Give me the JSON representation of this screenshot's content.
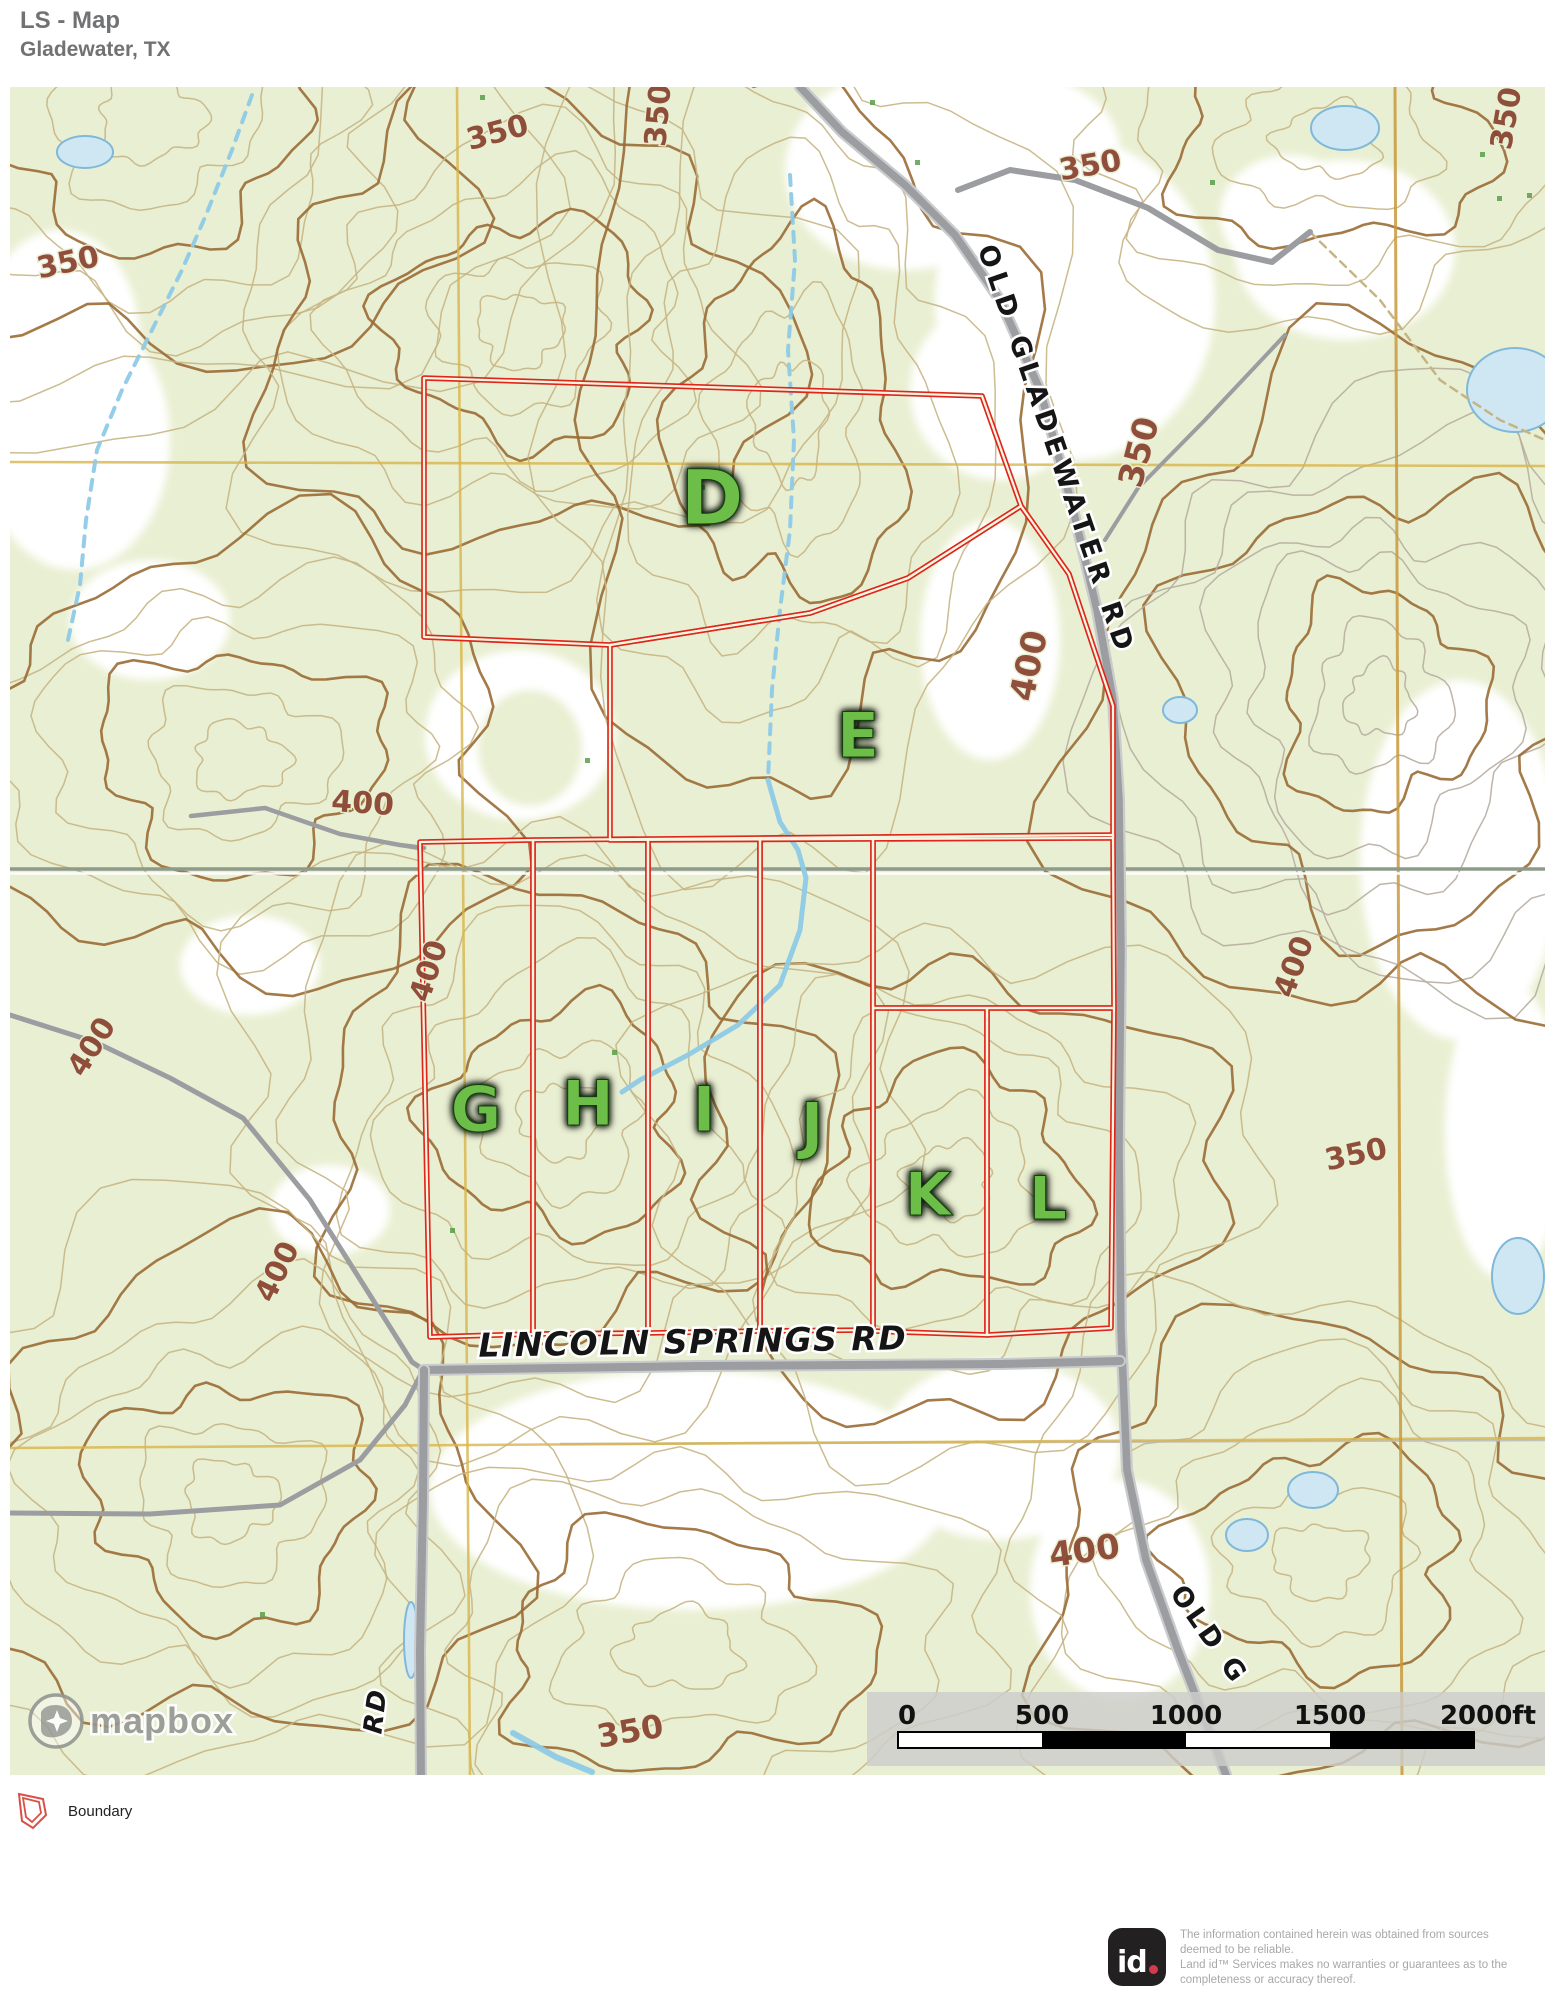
{
  "header": {
    "title": "LS - Map",
    "subtitle": "Gladewater, TX"
  },
  "legend": {
    "boundary_label": "Boundary"
  },
  "attribution": {
    "mapbox_label": "mapbox"
  },
  "footer": {
    "disclaimer": "The information contained herein was obtained from sources\ndeemed to be reliable.\nLand id™ Services makes no warranties or guarantees as to the\ncompleteness or accuracy thereof."
  },
  "colors": {
    "map_bg": "#e9efd2",
    "white_patch": "#ffffff",
    "contour": "#c6b584",
    "contour_gray": "#b7ada0",
    "contour_index": "#9a6b35",
    "contour_label": "#8b4632",
    "water_fill": "#cfe7f3",
    "water_stroke": "#7fb8d9",
    "stream": "#8ecae6",
    "road_core": "#9b9da0",
    "road_casing": "#c9cbcd",
    "grid_yellow": "#d9b54a",
    "grid_orange": "#c99a3e",
    "section_line": "#8e9b8a",
    "parcel_red": "#e0251b",
    "parcel_inner": "#f3f6e0",
    "letter_green": "#6cbe4a",
    "letter_glow": "#0b140b",
    "label_black": "#151515",
    "halo_white": "#ffffff",
    "scalebar_band": "#cdcdca",
    "mapbox_gray": "#949792",
    "legend_red": "#d95045"
  },
  "map": {
    "view_box": "10 87 1535 1688",
    "parcels": [
      {
        "id": "D",
        "points": "424,378 982,396 1021,506 908,578 810,613 610,645 424,637",
        "label": {
          "text": "D",
          "x": 712,
          "y": 524,
          "size": 76
        }
      },
      {
        "id": "E",
        "points": "610,645 810,613 908,578 1021,506 1069,574 1113,706 1113,838 610,840",
        "label": {
          "text": "E",
          "x": 858,
          "y": 757,
          "size": 62
        }
      },
      {
        "id": "G",
        "points": "420,842 533,840 533,1334 430,1337",
        "label": {
          "text": "G",
          "x": 476,
          "y": 1131,
          "size": 62
        }
      },
      {
        "id": "H",
        "points": "533,840 648,839 648,1333 533,1334",
        "label": {
          "text": "H",
          "x": 588,
          "y": 1125,
          "size": 62
        }
      },
      {
        "id": "I",
        "points": "648,839 760,838 760,1331 648,1333",
        "label": {
          "text": "I",
          "x": 704,
          "y": 1131,
          "size": 62
        }
      },
      {
        "id": "J",
        "points": "760,838 873,837 873,1330 760,1331",
        "label": {
          "text": "J",
          "x": 812,
          "y": 1147,
          "size": 62
        }
      },
      {
        "id": "F",
        "points": "873,837 1113,835 1114,1008 873,1008",
        "label": null
      },
      {
        "id": "K",
        "points": "873,1008 987,1008 987,1335 873,1331",
        "label": {
          "text": "K",
          "x": 928,
          "y": 1215,
          "size": 60
        }
      },
      {
        "id": "L",
        "points": "987,1008 1114,1008 1111,1328 987,1335",
        "label": {
          "text": "L",
          "x": 1048,
          "y": 1219,
          "size": 60
        }
      }
    ],
    "road_labels": [
      {
        "text": "OLD GLADEWATER RD",
        "x": 1048,
        "y": 453,
        "rot": 71,
        "size": 27,
        "spacing": 6,
        "italic": false
      },
      {
        "text": "LINCOLN SPRINGS RD",
        "x": 693,
        "y": 1353,
        "rot": -1,
        "size": 33,
        "spacing": 1.5,
        "italic": true
      },
      {
        "text": "OLD G",
        "x": 1202,
        "y": 1640,
        "rot": 55,
        "size": 27,
        "spacing": 4,
        "italic": false
      },
      {
        "text": "RD",
        "x": 384,
        "y": 1712,
        "rot": -83,
        "size": 26,
        "spacing": 2,
        "italic": true
      }
    ],
    "contour_labels": [
      {
        "text": "350",
        "x": 70,
        "y": 272,
        "rot": -12,
        "size": 30
      },
      {
        "text": "350",
        "x": 500,
        "y": 142,
        "rot": -15,
        "size": 30
      },
      {
        "text": "350",
        "x": 668,
        "y": 116,
        "rot": -85,
        "size": 30
      },
      {
        "text": "350",
        "x": 1092,
        "y": 175,
        "rot": -10,
        "size": 30
      },
      {
        "text": "350",
        "x": 1516,
        "y": 120,
        "rot": -80,
        "size": 30
      },
      {
        "text": "350",
        "x": 1150,
        "y": 455,
        "rot": -75,
        "size": 34
      },
      {
        "text": "400",
        "x": 1040,
        "y": 668,
        "rot": -78,
        "size": 34
      },
      {
        "text": "400",
        "x": 362,
        "y": 813,
        "rot": 4,
        "size": 30
      },
      {
        "text": "400",
        "x": 100,
        "y": 1052,
        "rot": -58,
        "size": 30
      },
      {
        "text": "400",
        "x": 438,
        "y": 974,
        "rot": -72,
        "size": 30
      },
      {
        "text": "400",
        "x": 1303,
        "y": 970,
        "rot": -70,
        "size": 30
      },
      {
        "text": "350",
        "x": 1358,
        "y": 1164,
        "rot": -12,
        "size": 30
      },
      {
        "text": "400",
        "x": 286,
        "y": 1276,
        "rot": -64,
        "size": 30
      },
      {
        "text": "400",
        "x": 1086,
        "y": 1562,
        "rot": -8,
        "size": 34
      },
      {
        "text": "350",
        "x": 632,
        "y": 1742,
        "rot": -10,
        "size": 32
      }
    ],
    "roads": {
      "main": [
        [
          800,
          87
        ],
        [
          842,
          132
        ],
        [
          905,
          185
        ],
        [
          955,
          235
        ],
        [
          1000,
          300
        ],
        [
          1040,
          390
        ],
        [
          1072,
          505
        ],
        [
          1097,
          610
        ],
        [
          1113,
          700
        ],
        [
          1119,
          800
        ],
        [
          1121,
          950
        ],
        [
          1119,
          1150
        ],
        [
          1121,
          1330
        ],
        [
          1127,
          1470
        ],
        [
          1146,
          1560
        ],
        [
          1178,
          1650
        ],
        [
          1205,
          1720
        ],
        [
          1228,
          1780
        ]
      ],
      "lincoln": [
        [
          424,
          1370
        ],
        [
          700,
          1366
        ],
        [
          1000,
          1364
        ],
        [
          1120,
          1361
        ]
      ],
      "south": [
        [
          424,
          1370
        ],
        [
          423,
          1500
        ],
        [
          420,
          1650
        ],
        [
          421,
          1780
        ]
      ],
      "trail_a": [
        [
          10,
          1015
        ],
        [
          95,
          1042
        ],
        [
          170,
          1078
        ],
        [
          243,
          1118
        ],
        [
          310,
          1200
        ],
        [
          368,
          1292
        ],
        [
          412,
          1362
        ],
        [
          424,
          1370
        ]
      ],
      "trail_b": [
        [
          10,
          1513
        ],
        [
          150,
          1514
        ],
        [
          280,
          1505
        ],
        [
          360,
          1460
        ],
        [
          405,
          1405
        ],
        [
          422,
          1372
        ]
      ],
      "trail_c": [
        [
          191,
          816
        ],
        [
          265,
          808
        ],
        [
          340,
          834
        ],
        [
          400,
          845
        ],
        [
          424,
          848
        ]
      ],
      "branch": [
        [
          958,
          190
        ],
        [
          1010,
          170
        ],
        [
          1075,
          180
        ],
        [
          1148,
          208
        ],
        [
          1218,
          250
        ],
        [
          1272,
          262
        ],
        [
          1310,
          232
        ]
      ],
      "merge": [
        [
          1285,
          335
        ],
        [
          1205,
          420
        ],
        [
          1138,
          488
        ],
        [
          1105,
          540
        ]
      ]
    },
    "streams": {
      "left_dashed": [
        [
          252,
          95
        ],
        [
          232,
          150
        ],
        [
          206,
          215
        ],
        [
          182,
          270
        ],
        [
          152,
          330
        ],
        [
          122,
          390
        ],
        [
          97,
          450
        ],
        [
          86,
          520
        ],
        [
          80,
          585
        ],
        [
          68,
          640
        ]
      ],
      "center_dashed": [
        [
          790,
          175
        ],
        [
          795,
          260
        ],
        [
          788,
          350
        ],
        [
          794,
          440
        ],
        [
          790,
          530
        ],
        [
          780,
          610
        ],
        [
          772,
          690
        ],
        [
          768,
          780
        ]
      ],
      "center_solid": [
        [
          768,
          780
        ],
        [
          780,
          822
        ],
        [
          798,
          850
        ],
        [
          806,
          878
        ],
        [
          800,
          930
        ],
        [
          780,
          985
        ],
        [
          738,
          1025
        ],
        [
          688,
          1055
        ],
        [
          640,
          1080
        ],
        [
          622,
          1092
        ]
      ],
      "bottom_left": [
        [
          513,
          1733
        ],
        [
          556,
          1757
        ],
        [
          592,
          1772
        ]
      ]
    },
    "ponds": [
      [
        85,
        152,
        28,
        16
      ],
      [
        1345,
        128,
        34,
        22
      ],
      [
        1515,
        390,
        48,
        42
      ],
      [
        1180,
        710,
        17,
        13
      ],
      [
        1518,
        1276,
        26,
        38
      ],
      [
        1313,
        1490,
        25,
        18
      ],
      [
        1247,
        1535,
        21,
        16
      ],
      [
        411,
        1640,
        7,
        38
      ]
    ],
    "grid": {
      "vertical": [
        [
          457,
          87,
          470,
          1775
        ],
        [
          1395,
          87,
          1402,
          1775
        ]
      ],
      "horizontal": [
        [
          10,
          462,
          1545,
          466
        ],
        [
          10,
          1448,
          1545,
          1438
        ]
      ]
    },
    "section_line_y": 869,
    "scalebar": {
      "band": [
        867,
        1692,
        678,
        74
      ],
      "bar": [
        898,
        1732,
        576,
        16
      ],
      "segment_w": 144,
      "tick_labels": [
        "0",
        "500",
        "1000",
        "1500",
        "2000ft"
      ],
      "tick_x": [
        898,
        1042,
        1186,
        1330,
        1488
      ],
      "label_y": 1724,
      "font_size": 26
    }
  }
}
